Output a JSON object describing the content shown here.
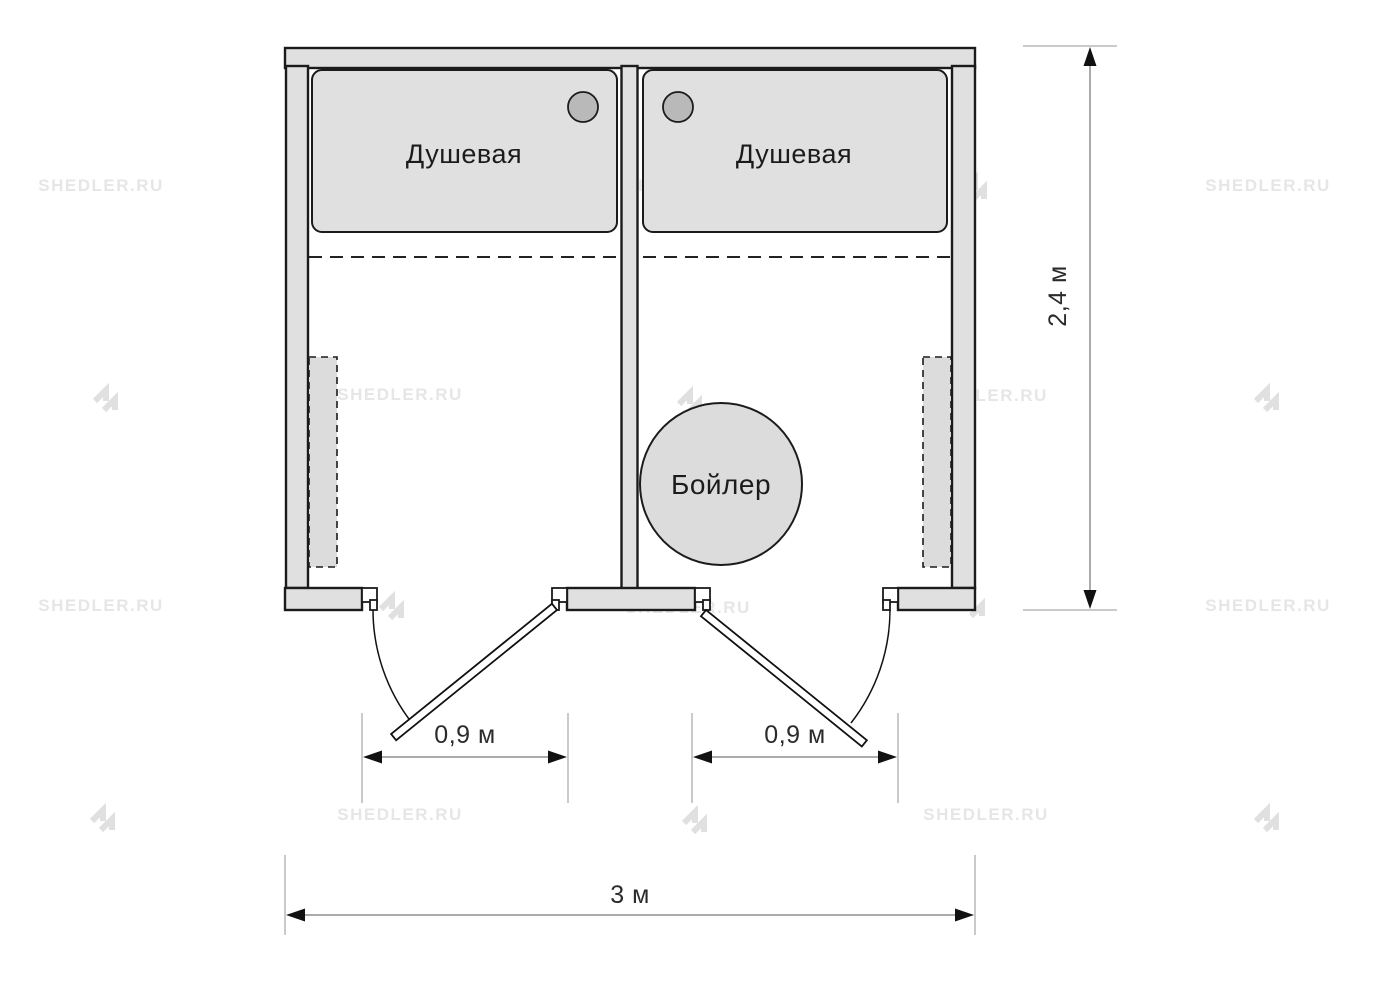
{
  "watermark": {
    "text": "SHEDLER.RU",
    "logo": "shedler-logo"
  },
  "plan": {
    "rooms": [
      {
        "label": "Душевая"
      },
      {
        "label": "Душевая"
      }
    ],
    "boiler": {
      "label": "Бойлер"
    },
    "dimensions": {
      "door_left": {
        "label": "0,9 м"
      },
      "door_right": {
        "label": "0,9 м"
      },
      "total_width": {
        "label": "3 м"
      },
      "total_height": {
        "label": "2,4 м"
      }
    }
  },
  "colors": {
    "background": "#ffffff",
    "wall_fill": "#e0e0e0",
    "wall_stroke": "#1b1b1b",
    "tray_fill": "#e0e0e0",
    "drain_fill": "#b9b9b9",
    "fixture_fill": "#dcdcdc",
    "boiler_fill": "#dcdcdc",
    "dim_line": "#8f8f8f",
    "ext_line": "#b9b9b9",
    "arrow": "#111111",
    "label_text": "#1c1c1c",
    "dim_text": "#2b2b2b",
    "watermark_text": "#e6e6e6",
    "watermark_logo": "#e0e0e0"
  }
}
